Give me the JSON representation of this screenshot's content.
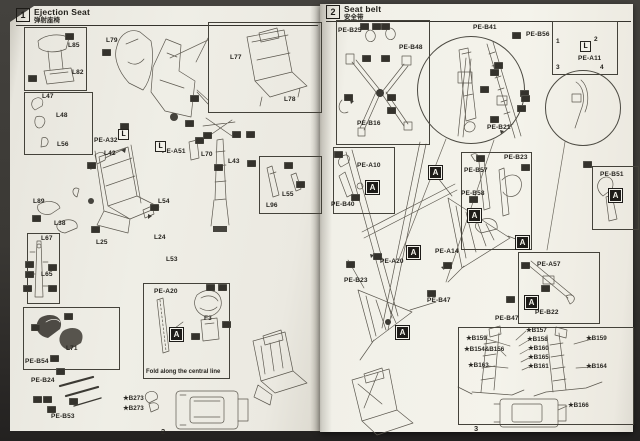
{
  "colors": {
    "ink": "#26241f",
    "line": "#5c584f",
    "chip": "#34322c",
    "badge_bg": "#1e1c19",
    "page": "#efeee6"
  },
  "pages": [
    {
      "step": "1",
      "title": "Ejection Seat",
      "title_cn": "弹射座椅",
      "page_num": "2",
      "badge_letter": "A",
      "boxes": [
        {
          "x": 24,
          "y": 27,
          "w": 61,
          "h": 62
        },
        {
          "x": 24,
          "y": 92,
          "w": 67,
          "h": 61
        },
        {
          "x": 27,
          "y": 233,
          "w": 31,
          "h": 69
        },
        {
          "x": 259,
          "y": 156,
          "w": 61,
          "h": 56
        },
        {
          "x": 23,
          "y": 307,
          "w": 95,
          "h": 61
        },
        {
          "x": 143,
          "y": 283,
          "w": 85,
          "h": 94
        },
        {
          "x": 208,
          "y": 22,
          "w": 112,
          "h": 89
        }
      ],
      "circles": [],
      "labels": [
        {
          "t": "L85",
          "x": 68,
          "y": 42
        },
        {
          "t": "L82",
          "x": 72,
          "y": 69
        },
        {
          "t": "L79",
          "x": 106,
          "y": 37
        },
        {
          "t": "L47",
          "x": 42,
          "y": 93
        },
        {
          "t": "L48",
          "x": 56,
          "y": 112
        },
        {
          "t": "L56",
          "x": 57,
          "y": 141
        },
        {
          "t": "PE-A32",
          "x": 94,
          "y": 137
        },
        {
          "t": "L42",
          "x": 104,
          "y": 150
        },
        {
          "t": "PE-A51",
          "x": 162,
          "y": 148
        },
        {
          "t": "L77",
          "x": 230,
          "y": 54
        },
        {
          "t": "L78",
          "x": 284,
          "y": 96
        },
        {
          "t": "L70",
          "x": 201,
          "y": 151
        },
        {
          "t": "L43",
          "x": 228,
          "y": 158
        },
        {
          "t": "L54",
          "x": 158,
          "y": 198
        },
        {
          "t": "L55",
          "x": 282,
          "y": 191
        },
        {
          "t": "L96",
          "x": 266,
          "y": 202
        },
        {
          "t": "L89",
          "x": 33,
          "y": 198
        },
        {
          "t": "L38",
          "x": 54,
          "y": 220
        },
        {
          "t": "L67",
          "x": 41,
          "y": 235
        },
        {
          "t": "L65",
          "x": 41,
          "y": 271
        },
        {
          "t": "L25",
          "x": 96,
          "y": 239
        },
        {
          "t": "L24",
          "x": 154,
          "y": 234
        },
        {
          "t": "L53",
          "x": 166,
          "y": 256
        },
        {
          "t": "L71",
          "x": 66,
          "y": 345
        },
        {
          "t": "PE-B54",
          "x": 25,
          "y": 358
        },
        {
          "t": "PE-B24",
          "x": 31,
          "y": 377
        },
        {
          "t": "PE-B53",
          "x": 51,
          "y": 413
        },
        {
          "t": "PE-A20",
          "x": 154,
          "y": 288
        },
        {
          "t": "F3",
          "x": 204,
          "y": 315
        }
      ],
      "stars": [
        {
          "t": "★B273",
          "x": 123,
          "y": 395
        },
        {
          "t": "★B273",
          "x": 123,
          "y": 405
        }
      ],
      "badges": [
        {
          "t": "A",
          "x": 170,
          "y": 328
        }
      ],
      "brackets": [
        {
          "t": "L",
          "x": 118,
          "y": 129
        },
        {
          "t": "L",
          "x": 155,
          "y": 141
        }
      ],
      "notes": [
        {
          "t": "Fold along the central line",
          "x": 146,
          "y": 369
        }
      ],
      "chips": [
        {
          "x": 65,
          "y": 33
        },
        {
          "x": 28,
          "y": 75
        },
        {
          "x": 102,
          "y": 49
        },
        {
          "x": 190,
          "y": 95
        },
        {
          "x": 185,
          "y": 120
        },
        {
          "x": 120,
          "y": 123
        },
        {
          "x": 87,
          "y": 162
        },
        {
          "x": 203,
          "y": 132
        },
        {
          "x": 232,
          "y": 131
        },
        {
          "x": 246,
          "y": 131
        },
        {
          "x": 195,
          "y": 137
        },
        {
          "x": 214,
          "y": 164
        },
        {
          "x": 247,
          "y": 160
        },
        {
          "x": 284,
          "y": 162
        },
        {
          "x": 296,
          "y": 181
        },
        {
          "x": 150,
          "y": 204
        },
        {
          "x": 91,
          "y": 226
        },
        {
          "x": 32,
          "y": 215
        },
        {
          "x": 25,
          "y": 261
        },
        {
          "x": 48,
          "y": 264
        },
        {
          "x": 25,
          "y": 271
        },
        {
          "x": 23,
          "y": 285
        },
        {
          "x": 48,
          "y": 285
        },
        {
          "x": 64,
          "y": 313
        },
        {
          "x": 31,
          "y": 324
        },
        {
          "x": 50,
          "y": 355
        },
        {
          "x": 56,
          "y": 368
        },
        {
          "x": 33,
          "y": 396
        },
        {
          "x": 43,
          "y": 396
        },
        {
          "x": 69,
          "y": 398
        },
        {
          "x": 47,
          "y": 406
        },
        {
          "x": 206,
          "y": 284
        },
        {
          "x": 218,
          "y": 284
        },
        {
          "x": 222,
          "y": 321
        },
        {
          "x": 191,
          "y": 333
        }
      ]
    },
    {
      "step": "2",
      "title": "Seat belt",
      "title_cn": "安全带",
      "page_num": "3",
      "badge_letter": "A",
      "boxes": [
        {
          "x": 336,
          "y": 20,
          "w": 92,
          "h": 123
        },
        {
          "x": 552,
          "y": 21,
          "w": 64,
          "h": 52
        },
        {
          "x": 333,
          "y": 147,
          "w": 60,
          "h": 65
        },
        {
          "x": 461,
          "y": 152,
          "w": 69,
          "h": 96
        },
        {
          "x": 592,
          "y": 166,
          "w": 45,
          "h": 62
        },
        {
          "x": 518,
          "y": 252,
          "w": 80,
          "h": 70
        },
        {
          "x": 458,
          "y": 327,
          "w": 174,
          "h": 96
        }
      ],
      "circles": [
        {
          "cx": 470,
          "cy": 89,
          "r": 53
        },
        {
          "cx": 582,
          "cy": 107,
          "r": 37
        }
      ],
      "labels": [
        {
          "t": "PE-B25",
          "x": 338,
          "y": 27
        },
        {
          "t": "PE-B48",
          "x": 399,
          "y": 44
        },
        {
          "t": "PE-B16",
          "x": 357,
          "y": 120
        },
        {
          "t": "PE-B41",
          "x": 473,
          "y": 24
        },
        {
          "t": "PE-B56",
          "x": 526,
          "y": 31
        },
        {
          "t": "PE-A11",
          "x": 578,
          "y": 55
        },
        {
          "t": "1",
          "x": 556,
          "y": 38
        },
        {
          "t": "2",
          "x": 594,
          "y": 36
        },
        {
          "t": "3",
          "x": 556,
          "y": 64
        },
        {
          "t": "4",
          "x": 600,
          "y": 64
        },
        {
          "t": "PE-B21",
          "x": 487,
          "y": 124
        },
        {
          "t": "PE-A10",
          "x": 357,
          "y": 162
        },
        {
          "t": "PE-B40",
          "x": 331,
          "y": 201
        },
        {
          "t": "PE-B57",
          "x": 464,
          "y": 167
        },
        {
          "t": "PE-B58",
          "x": 461,
          "y": 190
        },
        {
          "t": "PE-B23",
          "x": 504,
          "y": 154
        },
        {
          "t": "PE-B51",
          "x": 600,
          "y": 171
        },
        {
          "t": "PE-A20",
          "x": 380,
          "y": 258
        },
        {
          "t": "PE-A14",
          "x": 435,
          "y": 248
        },
        {
          "t": "PE-B23",
          "x": 344,
          "y": 277
        },
        {
          "t": "PE-B47",
          "x": 427,
          "y": 297
        },
        {
          "t": "PE-A57",
          "x": 537,
          "y": 261
        },
        {
          "t": "PE-B47",
          "x": 495,
          "y": 315
        },
        {
          "t": "PE-B22",
          "x": 535,
          "y": 309
        }
      ],
      "stars": [
        {
          "t": "★B159",
          "x": 466,
          "y": 335
        },
        {
          "t": "★B157",
          "x": 526,
          "y": 327
        },
        {
          "t": "★B158",
          "x": 527,
          "y": 336
        },
        {
          "t": "★B159",
          "x": 586,
          "y": 335
        },
        {
          "t": "★B154&B156",
          "x": 464,
          "y": 346
        },
        {
          "t": "★B160",
          "x": 528,
          "y": 345
        },
        {
          "t": "★B165",
          "x": 528,
          "y": 354
        },
        {
          "t": "★B163",
          "x": 468,
          "y": 362
        },
        {
          "t": "★B161",
          "x": 528,
          "y": 363
        },
        {
          "t": "★B164",
          "x": 586,
          "y": 363
        },
        {
          "t": "★B166",
          "x": 568,
          "y": 402
        }
      ],
      "badges": [
        {
          "t": "A",
          "x": 366,
          "y": 181
        },
        {
          "t": "A",
          "x": 429,
          "y": 166
        },
        {
          "t": "A",
          "x": 468,
          "y": 209
        },
        {
          "t": "A",
          "x": 516,
          "y": 236
        },
        {
          "t": "A",
          "x": 609,
          "y": 189
        },
        {
          "t": "A",
          "x": 407,
          "y": 246
        },
        {
          "t": "A",
          "x": 396,
          "y": 326
        },
        {
          "t": "A",
          "x": 525,
          "y": 296
        }
      ],
      "brackets": [
        {
          "t": "L",
          "x": 580,
          "y": 41
        }
      ],
      "notes": [],
      "chips": [
        {
          "x": 360,
          "y": 23
        },
        {
          "x": 372,
          "y": 23
        },
        {
          "x": 381,
          "y": 23
        },
        {
          "x": 362,
          "y": 55
        },
        {
          "x": 381,
          "y": 55
        },
        {
          "x": 344,
          "y": 94
        },
        {
          "x": 387,
          "y": 94
        },
        {
          "x": 387,
          "y": 107
        },
        {
          "x": 512,
          "y": 32
        },
        {
          "x": 494,
          "y": 62
        },
        {
          "x": 490,
          "y": 69
        },
        {
          "x": 480,
          "y": 86
        },
        {
          "x": 520,
          "y": 90
        },
        {
          "x": 521,
          "y": 95
        },
        {
          "x": 517,
          "y": 105
        },
        {
          "x": 490,
          "y": 116
        },
        {
          "x": 334,
          "y": 151
        },
        {
          "x": 351,
          "y": 194
        },
        {
          "x": 373,
          "y": 253
        },
        {
          "x": 443,
          "y": 262
        },
        {
          "x": 346,
          "y": 261
        },
        {
          "x": 427,
          "y": 290
        },
        {
          "x": 476,
          "y": 155
        },
        {
          "x": 521,
          "y": 164
        },
        {
          "x": 583,
          "y": 161
        },
        {
          "x": 469,
          "y": 196
        },
        {
          "x": 541,
          "y": 285
        },
        {
          "x": 506,
          "y": 296
        },
        {
          "x": 521,
          "y": 262
        }
      ]
    }
  ]
}
